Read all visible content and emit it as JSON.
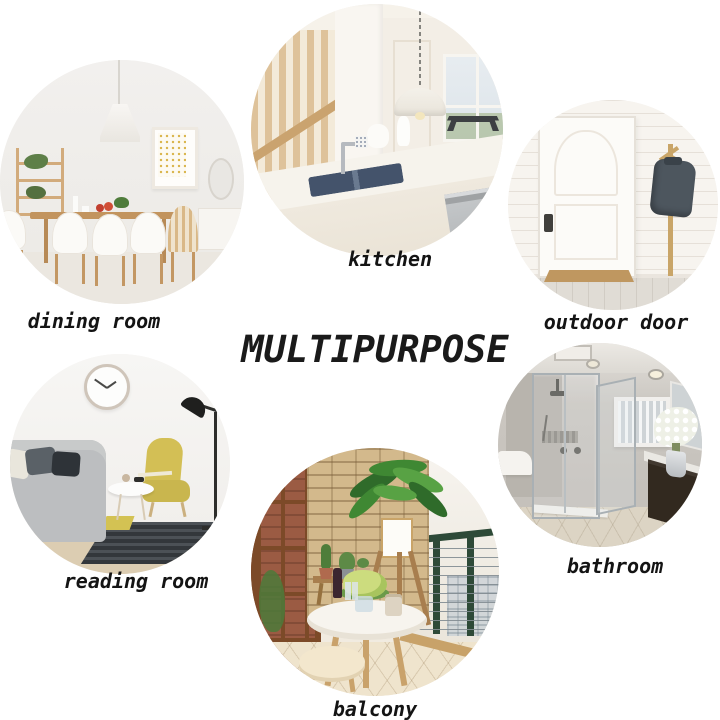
{
  "title": "MULTIPURPOSE",
  "rooms": [
    {
      "id": "dining-room",
      "label": "dining room"
    },
    {
      "id": "kitchen",
      "label": "kitchen"
    },
    {
      "id": "outdoor-door",
      "label": "outdoor door"
    },
    {
      "id": "reading-room",
      "label": "reading room"
    },
    {
      "id": "balcony",
      "label": "balcony"
    },
    {
      "id": "bathroom",
      "label": "bathroom"
    }
  ],
  "colors": {
    "background": "#ffffff",
    "label_text": "#141414",
    "title_text": "#1a1a1a",
    "wood": "#c49a66",
    "armchair_yellow": "#d3bf55",
    "plant_green": "#3f8833",
    "railing_green": "#2e4a38",
    "stone_tan": "#d3b98c",
    "jacket_gray": "#4d565e",
    "sink_navy": "#44536b",
    "brick_red": "#9b5b43"
  }
}
